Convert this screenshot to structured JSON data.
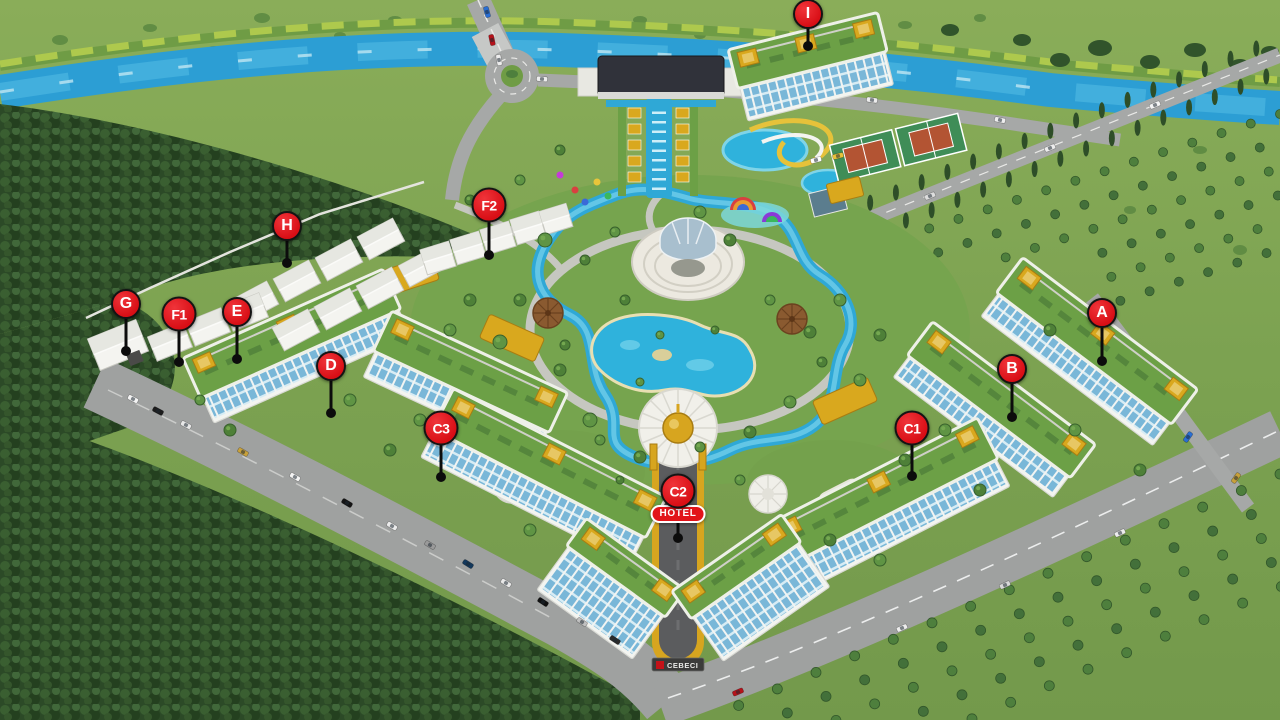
{
  "scene": {
    "hotel_badge": "HOTEL",
    "entrance_sign": "CEBECI",
    "colors": {
      "marker_red": "#e2141a",
      "marker_text": "#ffffff",
      "pin_black": "#0c0c0c",
      "badge_border": "#ffffff",
      "gold_accent": "#d7a51f",
      "river_blue": "#2c9ed4",
      "pool_blue": "#2fb2dc",
      "grass_green": "#7ca251",
      "forest_green": "#2c4a27",
      "roof_garden_green": "#6ca046",
      "road_gray": "#9fa1a0",
      "building_white": "#f3f4f0",
      "glazing_blue": "#79b7d8"
    },
    "markers": [
      {
        "label": "A",
        "x": 1102,
        "y": 313,
        "pin_end": 361
      },
      {
        "label": "B",
        "x": 1012,
        "y": 369,
        "pin_end": 417
      },
      {
        "label": "C1",
        "x": 912,
        "y": 428,
        "pin_end": 476
      },
      {
        "label": "C2",
        "x": 678,
        "y": 491,
        "pin_end": 538,
        "badge": "HOTEL"
      },
      {
        "label": "C3",
        "x": 441,
        "y": 428,
        "pin_end": 477
      },
      {
        "label": "D",
        "x": 331,
        "y": 366,
        "pin_end": 413
      },
      {
        "label": "E",
        "x": 237,
        "y": 312,
        "pin_end": 359
      },
      {
        "label": "F1",
        "x": 179,
        "y": 314,
        "pin_end": 362
      },
      {
        "label": "F2",
        "x": 489,
        "y": 205,
        "pin_end": 255
      },
      {
        "label": "G",
        "x": 126,
        "y": 304,
        "pin_end": 351
      },
      {
        "label": "H",
        "x": 287,
        "y": 226,
        "pin_end": 263
      },
      {
        "label": "I",
        "x": 808,
        "y": 14,
        "pin_end": 46
      }
    ]
  }
}
